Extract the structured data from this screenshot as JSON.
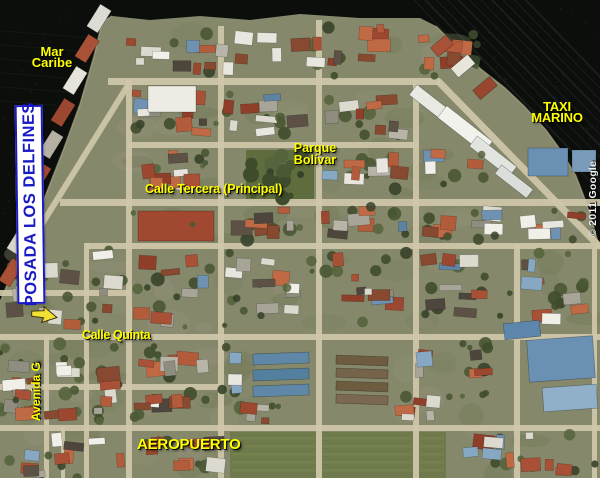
{
  "map": {
    "labels": {
      "sea_line1": "Mar",
      "sea_line2": "Caribe",
      "taxi_line1": "TAXI",
      "taxi_line2": "MARINO",
      "park_line1": "Parque",
      "park_line2": "Bolívar",
      "street_main": "Calle Tercera (Principal)",
      "street_quinta": "Calle Quinta",
      "avenue": "Avenida G",
      "airport": "AEROPUERTO",
      "hotel": "POSADA LOS DELFINES",
      "copyright": "© 2011 Google"
    },
    "colors": {
      "label_yellow": "#ffff00",
      "hotel_blue": "#1a1ac4",
      "hotel_bg": "#ffffff",
      "marker_yellow": "#f2e135",
      "water": "#0b0e0b",
      "land": "#85886b",
      "street": "#d0c7aa"
    },
    "marker": {
      "type": "arrow-pointer",
      "color": "#f2e135"
    }
  }
}
